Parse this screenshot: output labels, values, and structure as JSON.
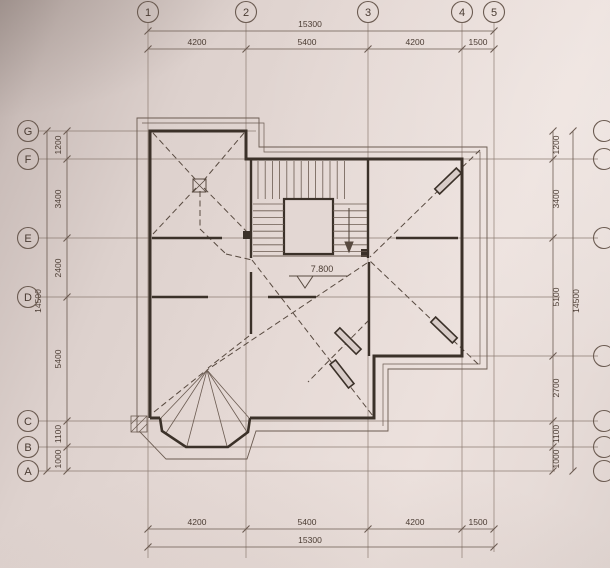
{
  "axes": {
    "top": [
      "1",
      "2",
      "3",
      "4",
      "5"
    ],
    "left": [
      "G",
      "F",
      "E",
      "D",
      "C",
      "B",
      "A"
    ]
  },
  "dimensions": {
    "top": {
      "total": "15300",
      "segments": [
        "4200",
        "5400",
        "4200",
        "1500"
      ]
    },
    "bottom": {
      "total": "15300",
      "segments": [
        "4200",
        "5400",
        "4200",
        "1500"
      ]
    },
    "left": {
      "total": "14500",
      "segments": [
        "1200",
        "3400",
        "2400",
        "5400",
        "1100",
        "1000"
      ]
    },
    "right": {
      "total": "14500",
      "segments": [
        "1200",
        "3400",
        "5100",
        "2700",
        "1100",
        "1000"
      ]
    }
  },
  "annotations": {
    "elevation_label": "7.800"
  },
  "colors": {
    "paper": "#e3d7d3",
    "thin_line": "#6b5b51",
    "grid_line": "#8d7d73",
    "wall": "#3b3129",
    "dash_line": "#584a40",
    "text": "#4a3b32"
  }
}
